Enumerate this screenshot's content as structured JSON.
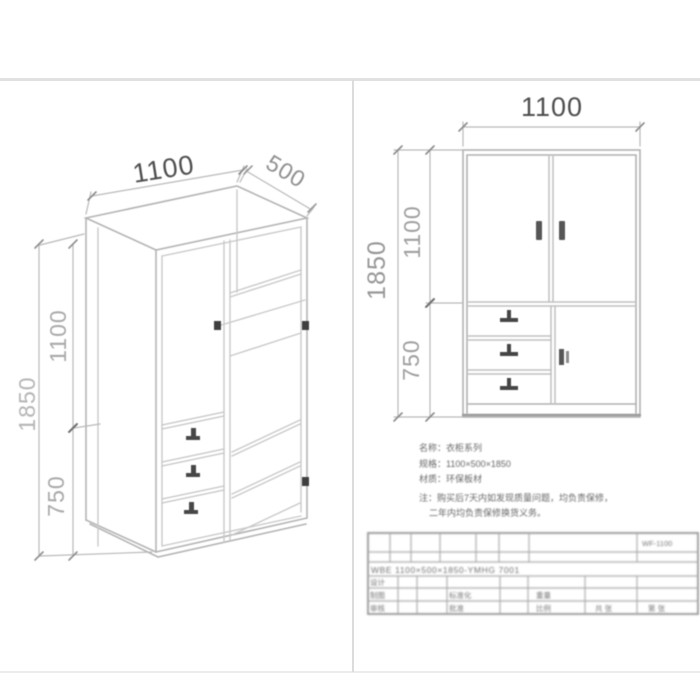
{
  "colors": {
    "line_light": "#c6c6c6",
    "line_mid": "#b0b0b0",
    "line_dark": "#9a9a9a",
    "handle_dark": "#474747",
    "divider": "#dcdcdc"
  },
  "iso_view": {
    "dim_width": "1100",
    "dim_depth": "500",
    "dim_height": "1850",
    "dim_upper": "1100",
    "dim_lower": "750"
  },
  "front_view": {
    "dim_width": "1100",
    "dim_height": "1850",
    "dim_upper": "1100",
    "dim_lower": "750"
  },
  "notes": {
    "line1": "名称：衣柜系列",
    "line2": "规格：1100×500×1850",
    "line3": "材质：环保板材",
    "line4": "注：购买后7天内如发现质量问题，均负责保修，",
    "line5": "二年内均负责保修换货义务。"
  },
  "title_block": {
    "code": "WF-1100",
    "spec": "WBE 1100×500×1850-YMHG 7001",
    "row_label_1": "设计",
    "row_label_2": "制图",
    "row_label_3": "审核",
    "mid_label_2": "标准化",
    "mid_label_3": "批准",
    "right_label_2": "重量",
    "right_label_3": "比例",
    "sheet_total": "共 张",
    "sheet_no": "第 张"
  }
}
